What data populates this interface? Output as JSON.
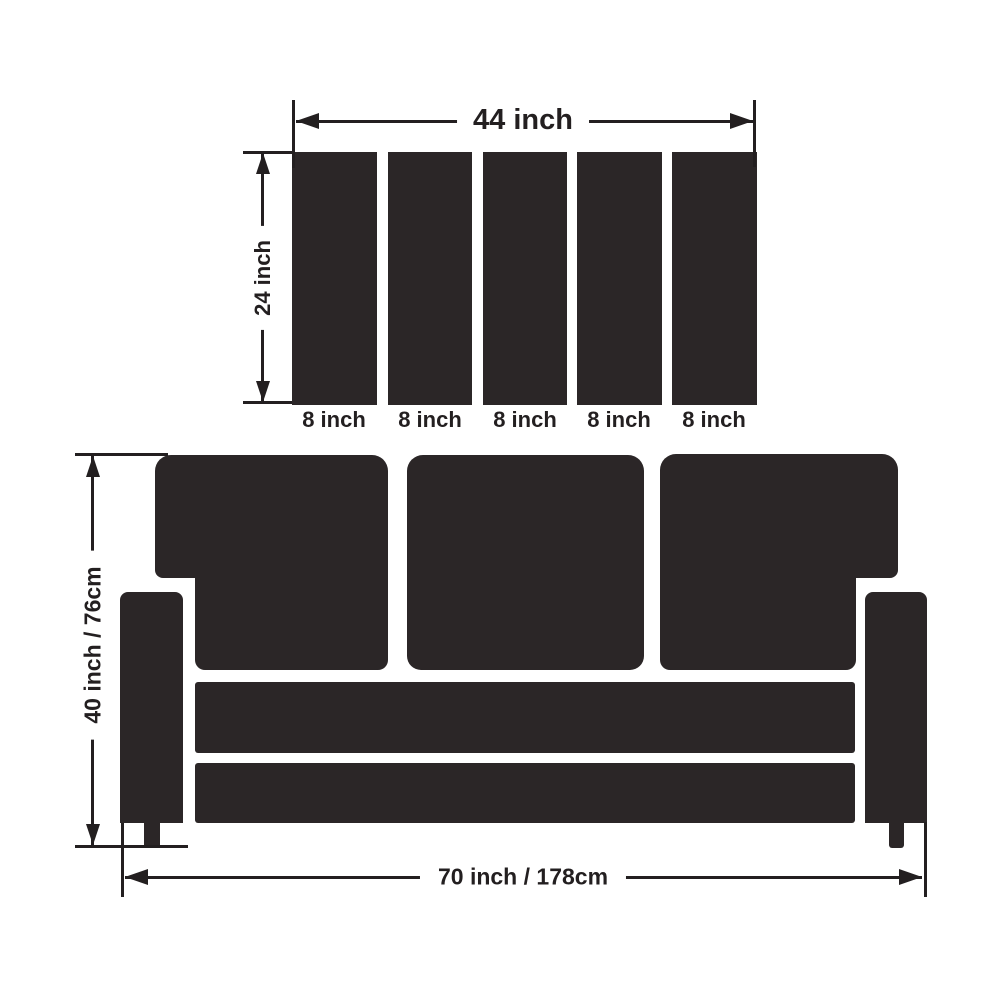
{
  "colors": {
    "shape_fill": "#2b2627",
    "line": "#231f20",
    "text": "#231f20",
    "bg": "#ffffff"
  },
  "top_diagram": {
    "description": "back cushion panel with five slats",
    "width_label": "44 inch",
    "height_label": "24 inch",
    "slat_labels": [
      "8 inch",
      "8 inch",
      "8 inch",
      "8 inch",
      "8 inch"
    ]
  },
  "sofa_diagram": {
    "description": "three-seat sofa front view",
    "height_label": "40 inch / 76cm",
    "width_label": "70 inch / 178cm"
  }
}
